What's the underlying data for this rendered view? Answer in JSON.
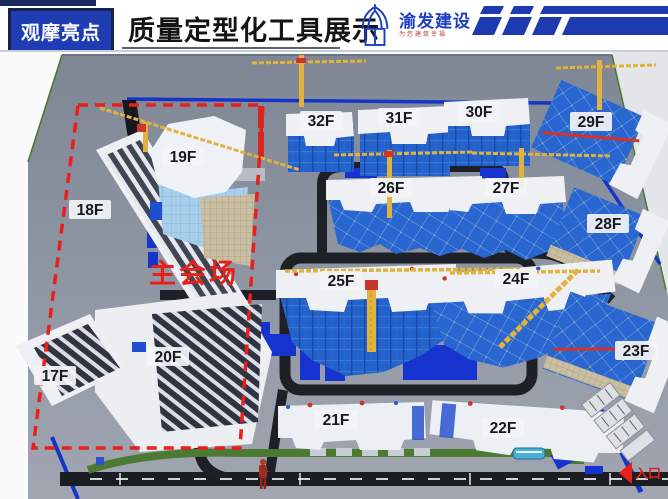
{
  "header": {
    "badge": "观摩亮点",
    "title": "质量定型化工具展示",
    "logo": {
      "name": "渝发建设",
      "tagline": "为您建筑幸福"
    }
  },
  "main": {
    "venue_label": "主会场",
    "entrance_label": "入口",
    "buildings": [
      {
        "label": "17F"
      },
      {
        "label": "18F"
      },
      {
        "label": "19F"
      },
      {
        "label": "20F"
      },
      {
        "label": "21F"
      },
      {
        "label": "22F"
      },
      {
        "label": "23F"
      },
      {
        "label": "24F"
      },
      {
        "label": "25F"
      },
      {
        "label": "26F"
      },
      {
        "label": "27F"
      },
      {
        "label": "28F"
      },
      {
        "label": "29F"
      },
      {
        "label": "30F"
      },
      {
        "label": "31F"
      },
      {
        "label": "32F"
      }
    ],
    "colors": {
      "accent_blue": "#1f3db3",
      "navy": "#1a2a5e",
      "dashed_red": "#e8201a",
      "scaffold_blue": "#2361cb",
      "crane_yellow": "#e2b23c",
      "ground_gray": "#8f96a3",
      "road_dark": "#1d2026",
      "fence_blue": "#1535c8",
      "hedge_green": "#4d7a32"
    }
  }
}
